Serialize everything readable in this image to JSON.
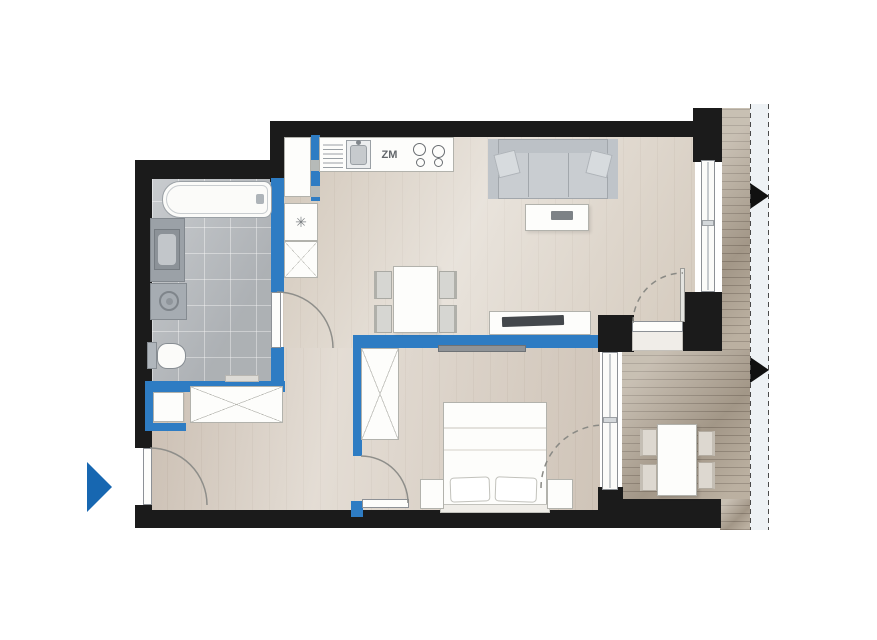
{
  "plan": {
    "labels": {
      "dishwasher": "ZM"
    },
    "icons": {
      "fridge_snowflake": "✳",
      "entrance_arrow": "right-pointing-triangle",
      "wardrobe_cross": "diagonal-cross",
      "railing_marker": "right-pointing-triangle"
    },
    "colors": {
      "structural_wall": "#1b1b1b",
      "partition_wall": "#2e7cc3",
      "entrance_arrow": "#1767b1",
      "wood_floor": "#dbd2c6",
      "bathroom_tile": "#b6babe",
      "balcony_deck": "#b3a796",
      "furniture_fill": "#fdfdfb",
      "sofa_fill": "#c9cdd1"
    },
    "fixtures": [
      "bathtub",
      "washbasin-vanity",
      "washing-machine",
      "toilet",
      "kitchen-sink",
      "dishwasher-ZM",
      "stove-4-burners",
      "fridge",
      "tall-cabinet",
      "hallway-wardrobe",
      "hallway-cabinet",
      "sofa",
      "coffee-table",
      "dining-table",
      "dining-chairs-4",
      "tv-console",
      "tv",
      "bedroom-wardrobe",
      "double-bed",
      "nightstands-2",
      "wall-shelf",
      "balcony-table",
      "balcony-chairs-4"
    ]
  }
}
